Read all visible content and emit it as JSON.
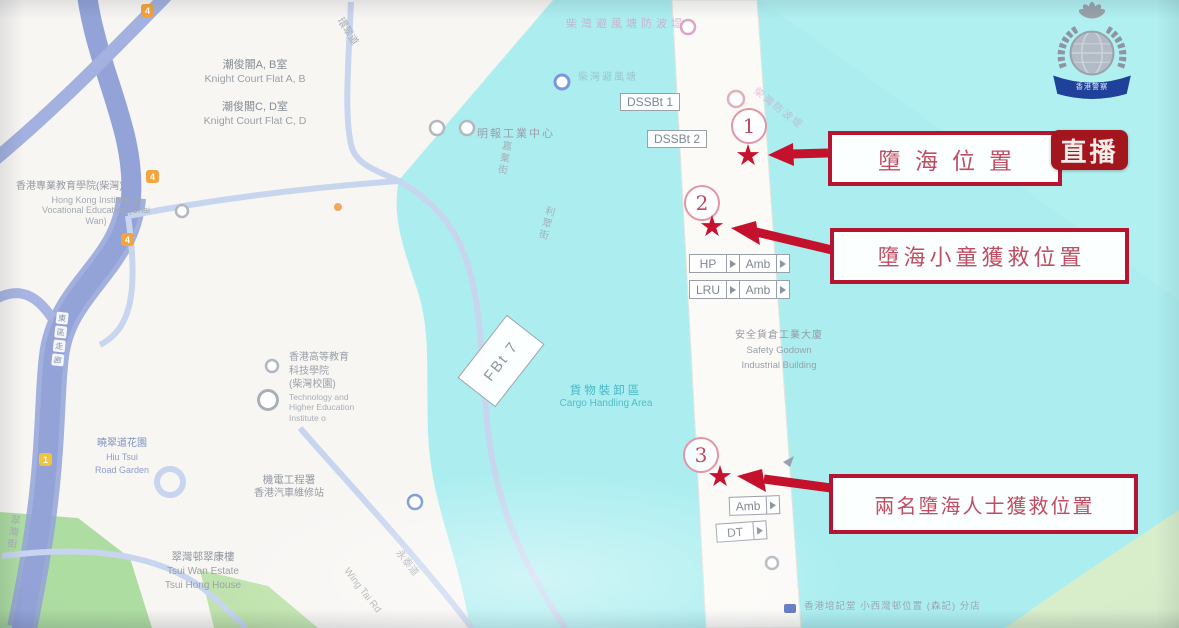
{
  "badge": {
    "live": "直播",
    "police_banner": "香港警察"
  },
  "callouts": [
    {
      "number": "1",
      "label": "墮海位置"
    },
    {
      "number": "2",
      "label": "墮海小童獲救位置"
    },
    {
      "number": "3",
      "label": "兩名墮海人士獲救位置"
    }
  ],
  "units": {
    "dssbt1": "DSSBt 1",
    "dssbt2": "DSSBt 2",
    "hp": "HP",
    "amb_row1": "Amb",
    "lru": "LRU",
    "amb_row2": "Amb",
    "amb_south": "Amb",
    "dt": "DT",
    "fbt7": "FBt 7"
  },
  "map": {
    "shields": [
      "4",
      "4",
      "4",
      "1"
    ],
    "corridor": [
      "東",
      "區",
      "走",
      "廊"
    ],
    "labels": {
      "knight_ab_zh": "潮俊閣A, B室",
      "knight_ab_en": "Knight Court Flat A, B",
      "knight_cd_zh": "潮俊閣C, D室",
      "knight_cd_en": "Knight Court Flat C, D",
      "ive_zh": "香港專業教育學院(柴灣)",
      "ive_en": "Hong Kong Institute of Vocational Education (Chai Wan)",
      "mingpao": "明報工業中心",
      "breakwater_top": "柴灣避風塘防波堤",
      "breakwater_inner": "柴灣避風塘",
      "breakwater_diag": "柴灣防波堤",
      "thei_zh1": "香港高等教育",
      "thei_zh2": "科技學院",
      "thei_zh3": "(柴灣校園)",
      "thei_en": "Technology and Higher Education Institute o",
      "cargo_zh": "貨物裝卸區",
      "cargo_en": "Cargo Handling Area",
      "godown_zh": "安全貨倉工業大廈",
      "godown_en1": "Safety Godown",
      "godown_en2": "Industrial Building",
      "emsd_zh1": "機電工程署",
      "emsd_zh2": "香港汽車維修站",
      "garden_zh": "曉翠道花園",
      "garden_en1": "Hiu Tsui",
      "garden_en2": "Road Garden",
      "tsui_zh": "翠灣邨翠康樓",
      "tsui_en1": "Tsui Wan Estate",
      "tsui_en2": "Tsui Hong House",
      "shop": "香港培記堂  小西灣邨位置 (森記) 分店",
      "road_wan_tsui": "環翠道",
      "road_ka_yip": "嘉業街",
      "road_lee_chung": "利眾街",
      "road_wing_tai_zh": "永泰道",
      "road_wing_tai_en": "Wing Tai Rd",
      "road_tsui_wan_st": "翠灣街"
    }
  },
  "colors": {
    "water": "#aceef0",
    "accent_red": "#c5122c",
    "live_badge_bg": "#a3161e"
  }
}
